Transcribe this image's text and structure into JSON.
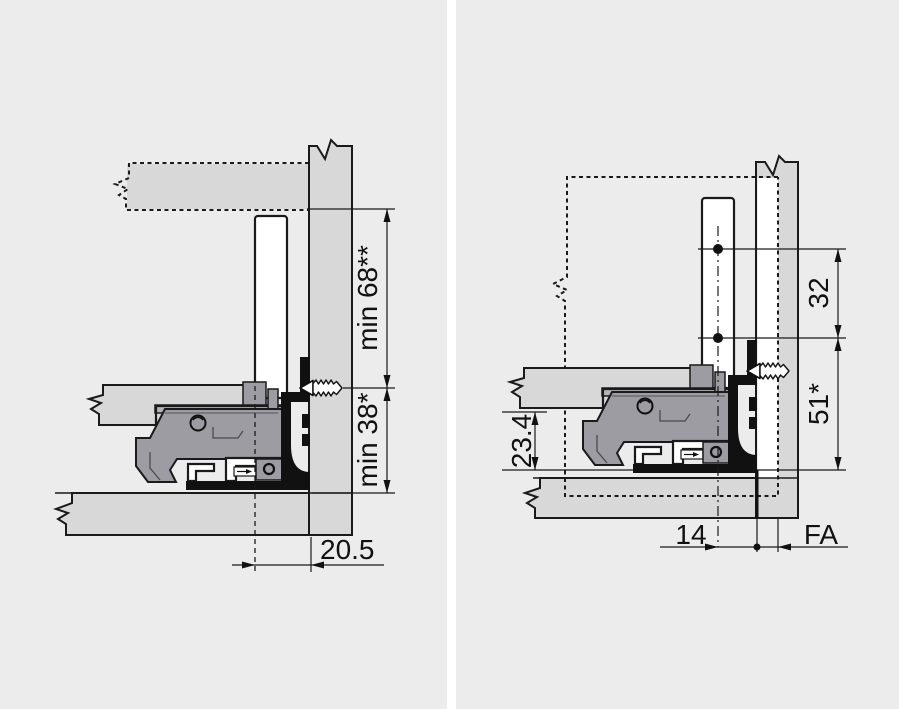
{
  "diagram_title": "drawer-runner-installation-cross-sections",
  "colors": {
    "background": "#ececec",
    "divider": "#ffffff",
    "board_fill": "#d8d8d8",
    "mechanism_fill": "#9c9ca2",
    "outline": "#1a1a1a",
    "black_profile": "#111111",
    "white": "#ffffff"
  },
  "left_diagram": {
    "name": "rear-wall-mounted-back",
    "dim_back_min": "min 68**",
    "dim_runner_min": "min 38*",
    "dim_gap": "20.5"
  },
  "right_diagram": {
    "name": "inset-back-panel-drilling",
    "dim_hole_spacing": "32",
    "dim_height": "51*",
    "dim_clearance": "23.4",
    "dim_hole_front": "14",
    "dim_fa": "FA"
  }
}
